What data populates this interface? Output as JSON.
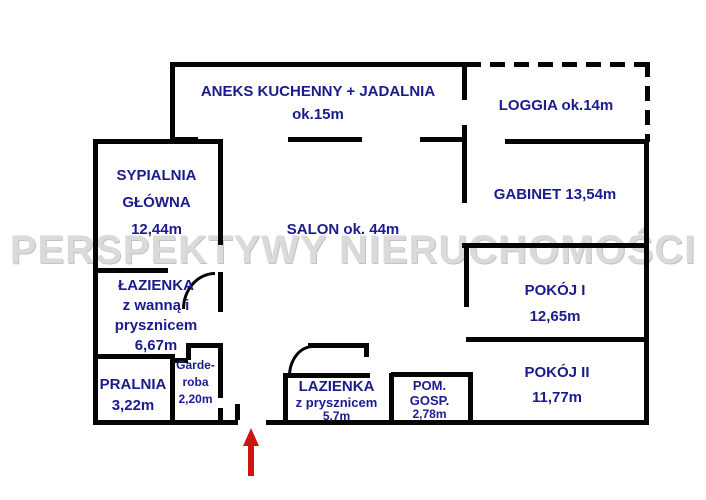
{
  "title": "Apartment floor plan",
  "watermark": {
    "text": "PERSPEKTYWY NIERUCHOMOŚCI"
  },
  "colors": {
    "label_navy": "#1b1b8e",
    "wall_black": "#050505",
    "watermark_gray": "#dadada",
    "arrow_red": "#cc1414",
    "background": "#ffffff"
  },
  "rooms": {
    "kitchen": {
      "line1": "ANEKS KUCHENNY + JADALNIA",
      "line2": "ok.15m"
    },
    "loggia": {
      "line1": "LOGGIA ok.14m"
    },
    "master_bedroom": {
      "line1": "SYPIALNIA",
      "line2": "GŁÓWNA",
      "line3": "12,44m"
    },
    "salon": {
      "line1": "SALON ok. 44m"
    },
    "gabinet": {
      "line1": "GABINET 13,54m"
    },
    "pokoj1": {
      "line1": "POKÓJ I",
      "line2": "12,65m"
    },
    "pokoj2": {
      "line1": "POKÓJ II",
      "line2": "11,77m"
    },
    "bathroom_main": {
      "line1": "ŁAZIENKA",
      "line2": "z wanną i",
      "line3": "prysznicem",
      "line4": "6,67m"
    },
    "pralnia": {
      "line1": "PRALNIA",
      "line2": "3,22m"
    },
    "garderoba": {
      "line1": "Garde-",
      "line2": "roba",
      "line3": "2,20m"
    },
    "bathroom_small": {
      "line1": "LAZIENKA",
      "line2": "z prysznicem",
      "line3": "5,7m"
    },
    "pom_gosp": {
      "line1": "POM.",
      "line2": "GOSP.",
      "line3": "2,78m"
    }
  },
  "entrance": {
    "symbol": "red-up-arrow"
  }
}
